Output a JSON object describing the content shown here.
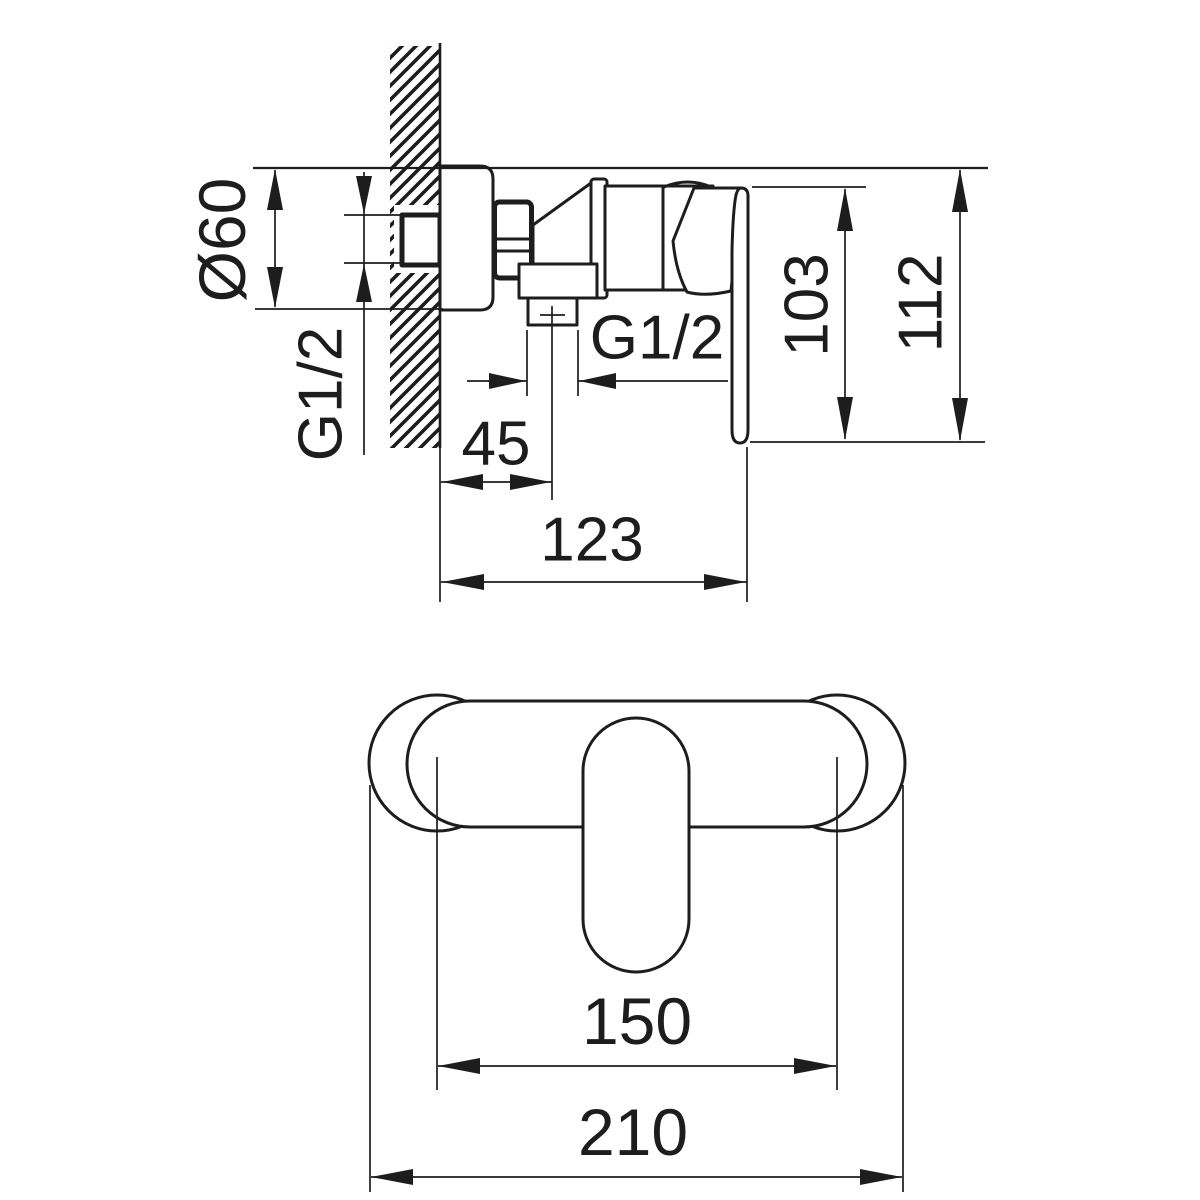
{
  "colors": {
    "background": "#ffffff",
    "line": "#1d1d1d"
  },
  "side_view": {
    "labels": {
      "flange_diameter": "Ø60",
      "wall_thread": "G1/2",
      "outlet_thread": "G1/2",
      "outlet_offset": "45",
      "depth_to_handle_end": "123",
      "handle_height": "103",
      "overall_height": "112"
    }
  },
  "top_view": {
    "labels": {
      "connection_spacing": "150",
      "overall_width": "210"
    }
  }
}
